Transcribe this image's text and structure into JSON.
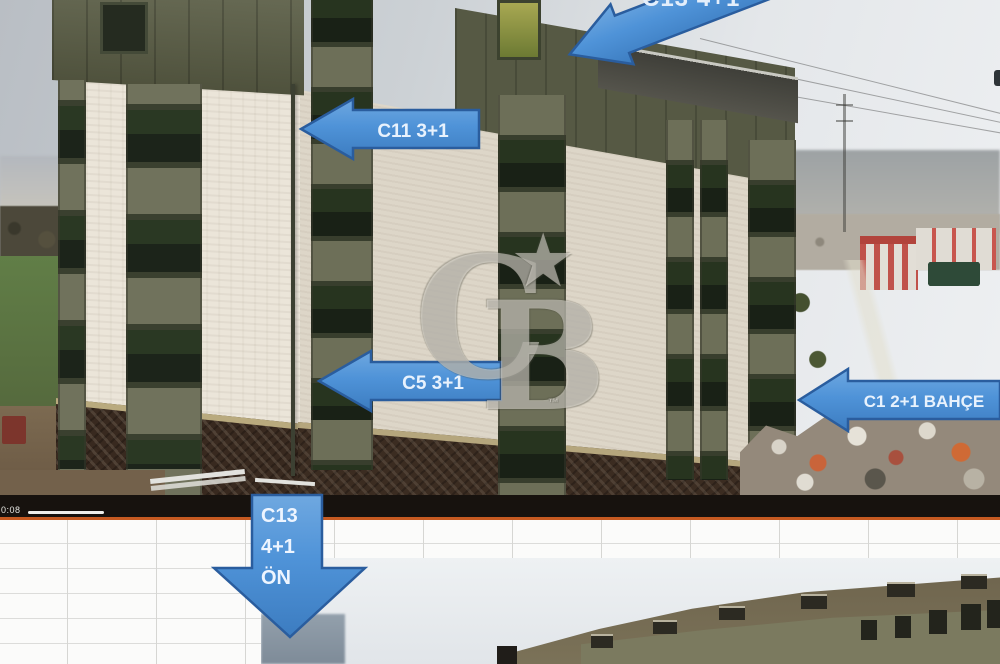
{
  "photo_labels": {
    "top_arrow": "C13 4+1",
    "c11_arrow": "C11 3+1",
    "c5_arrow": "C5 3+1",
    "c1_arrow": "C1 2+1 BAHÇE",
    "down_arrow_line1": "C13",
    "down_arrow_line2": "4+1",
    "down_arrow_line3": "ÖN"
  },
  "watermark": {
    "letter_c": "C",
    "letter_b": "B",
    "star": "★",
    "trademark": "™"
  },
  "video_bar": {
    "timestamp": "0:08"
  },
  "colors": {
    "arrow_fill": "#4F93D8",
    "arrow_border": "#2A5D9E",
    "accent_orange": "#C65A21",
    "watermark_tint": "#E9E7DE"
  }
}
